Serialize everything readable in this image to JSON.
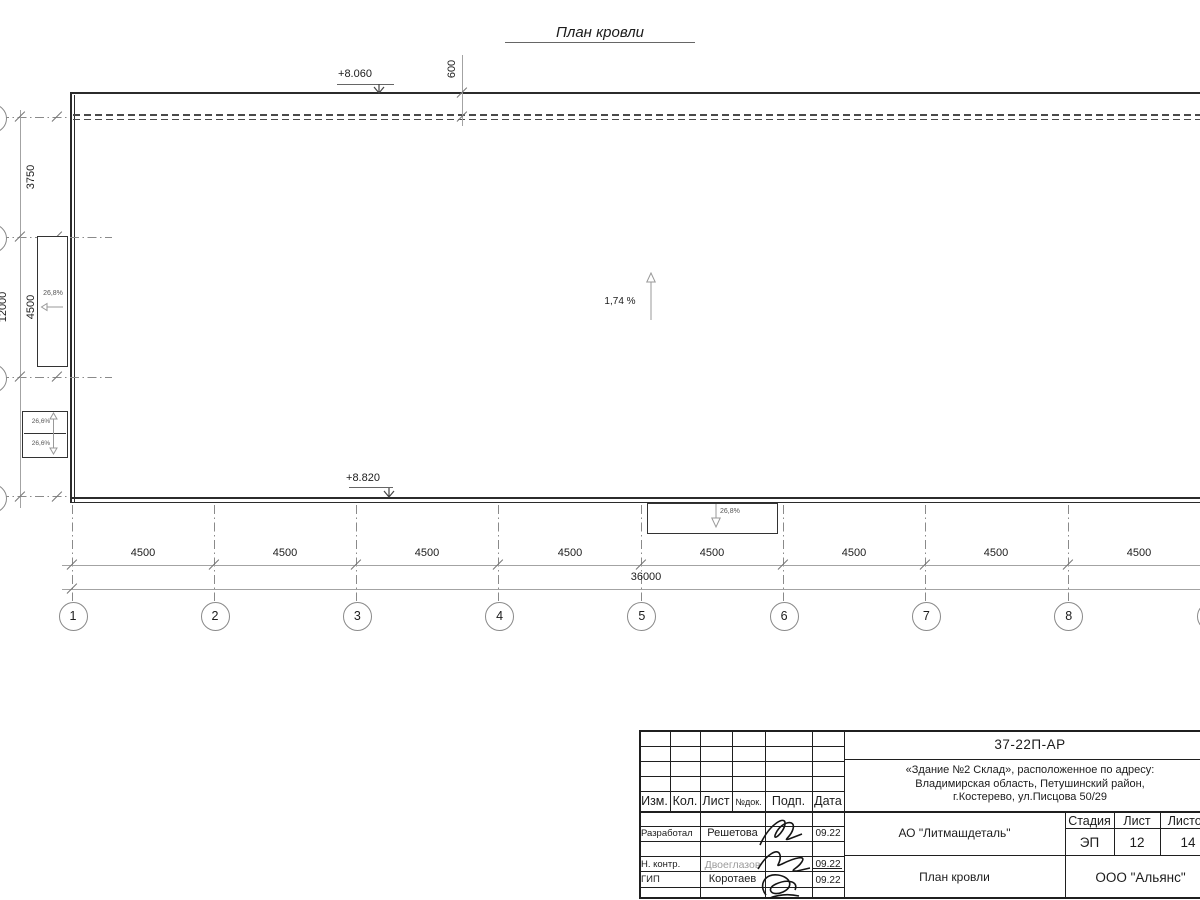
{
  "title": "План кровли",
  "elevations": {
    "top": "+8.060",
    "bottom": "+8.820"
  },
  "slopes": {
    "main": "1,74 %",
    "west": "26,8%",
    "south": "26,8%",
    "sw_upper": "26,6%",
    "sw_lower": "26,6%"
  },
  "dims": {
    "top_offset": "600",
    "left": [
      "3750",
      "4500",
      "3750"
    ],
    "left_total": "12000",
    "bottom": [
      "4500",
      "4500",
      "4500",
      "4500",
      "4500",
      "4500",
      "4500",
      "4500"
    ],
    "bottom_total": "36000"
  },
  "axes": [
    "1",
    "2",
    "3",
    "4",
    "5",
    "6",
    "7",
    "8"
  ],
  "titleblock": {
    "doc_number": "37-22П-АР",
    "address_lines": [
      "«Здание №2 Склад», расположенное по адресу:",
      "Владимирская область, Петушинский район,",
      "г.Костерево, ул.Писцова 50/29"
    ],
    "header_cols": [
      "Изм.",
      "Кол.",
      "Лист",
      "№док.",
      "Подп.",
      "Дата"
    ],
    "rows": [
      {
        "role": "Разработал",
        "name": "Решетова",
        "date": "09.22"
      },
      {
        "role": "Н. контр.",
        "name": "Двоеглазов",
        "date": "09.22"
      },
      {
        "role": "ГИП",
        "name": "Коротаев",
        "date": "09.22"
      }
    ],
    "company": "АО \"Литмашдеталь\"",
    "stage_label": "Стадия",
    "sheet_label": "Лист",
    "sheets_label": "Листов",
    "stage": "ЭП",
    "sheet": "12",
    "sheets": "14",
    "drawing_name": "План кровли",
    "contractor": "ООО \"Альянс\""
  }
}
